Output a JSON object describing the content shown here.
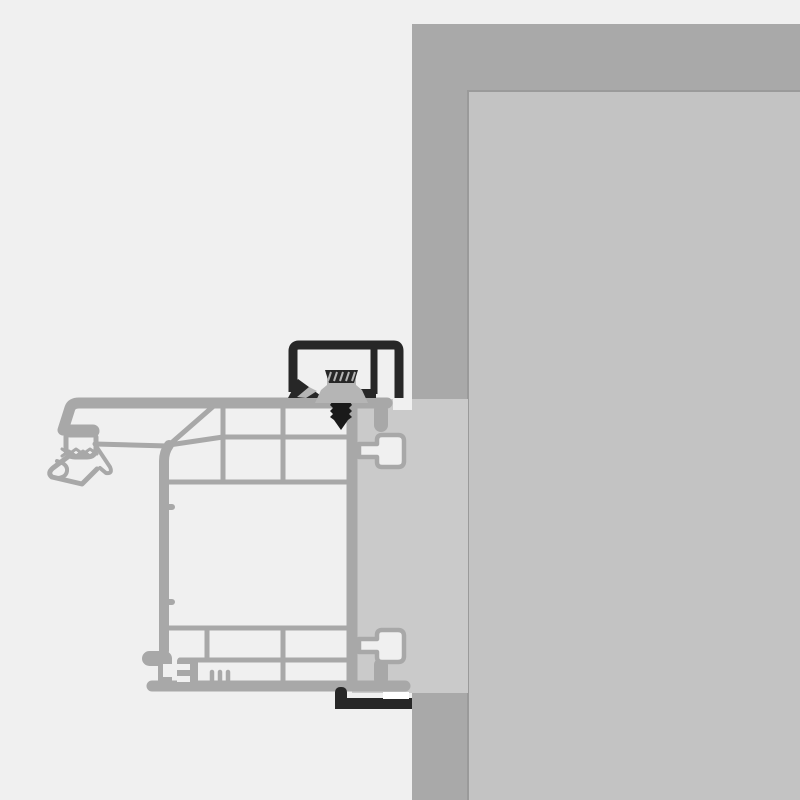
{
  "scene": {
    "kind": "technical-cross-section-illustration",
    "subject": "Window frame profile installed against a wall with top and bottom mounting brackets, frame anchor and fixing screw",
    "visible_text": ""
  },
  "canvas": {
    "width": 800,
    "height": 800
  },
  "colors": {
    "background": "#f0f0f0",
    "wall": "#a9a9a9",
    "panel": "#c3c3c3",
    "panel-edge": "#9a9a9a",
    "reveal": "#cacaca",
    "chamber": "#f0f0f0",
    "profile": "#a8a8a8",
    "bracket": "#272727",
    "screw": "#1a1a1a",
    "anchor": "#b5b5b5",
    "white": "#ffffff"
  },
  "parts": {
    "wall": {
      "label": "Masonry wall section (cut surface)"
    },
    "interior": {
      "label": "Interior wall surface"
    },
    "reveal": {
      "label": "Window reveal / plaster return"
    },
    "profile": {
      "label": "Multi-chamber window frame profile cross-section"
    },
    "gasket": {
      "label": "Outer seal and drip edge detail"
    },
    "endCap": {
      "label": "Bottom end-cap clip detail"
    },
    "topBracket": {
      "label": "Top installation bracket"
    },
    "anchor": {
      "label": "Frame anchor block"
    },
    "screw": {
      "label": "Fixing screw"
    },
    "bottomBracket": {
      "label": "Bottom installation bracket"
    }
  }
}
